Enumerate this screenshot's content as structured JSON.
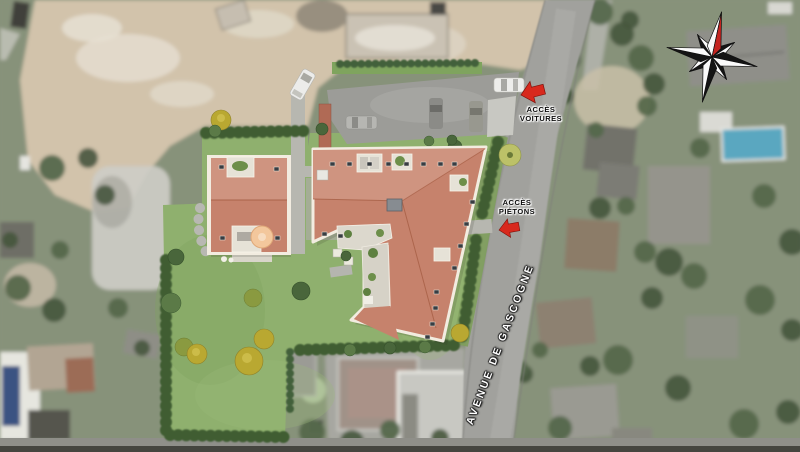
{
  "map": {
    "annotations": {
      "access_cars": {
        "line1": "ACCÈS",
        "line2": "VOITURES"
      },
      "access_pedestrians": {
        "line1": "ACCÈS",
        "line2": "PIÉTONS"
      },
      "street_name": "AVENUE DE GASCOGNE"
    },
    "icons": {
      "compass": "compass-rose-icon",
      "access_cars_arrow": "red-arrow-left-icon",
      "access_pedestrians_arrow": "red-arrow-left-icon"
    },
    "colors": {
      "roof_terracotta": "#c6826c",
      "roof_light": "#cf9480",
      "lawn_green": "#8fb06e",
      "hedge_green": "#3f5d33",
      "road_gray": "#a1a19d",
      "dirt_beige": "#d2c3ab",
      "arrow_red": "#d8291d",
      "compass_north_red": "#c42420",
      "pool_blue": "#5aa7c0"
    }
  }
}
